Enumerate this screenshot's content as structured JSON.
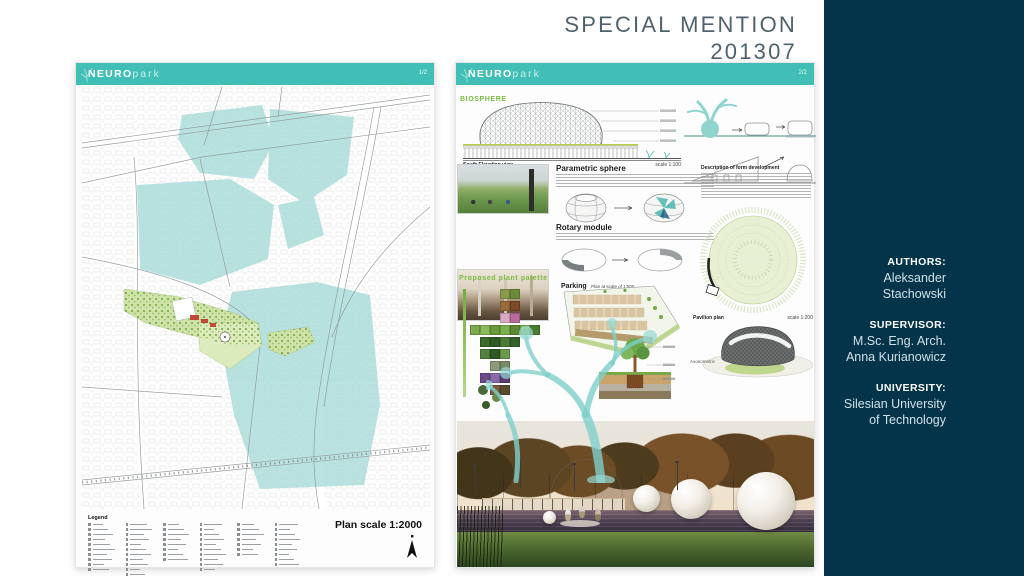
{
  "slide": {
    "title1": "SPECIAL MENTION",
    "title2": "201307"
  },
  "sidebar": {
    "authors_label": "AUTHORS:",
    "authors_name": "Aleksander Stachowski",
    "supervisor_label": "SUPERVISOR:",
    "supervisor_line1": "M.Sc. Eng. Arch.",
    "supervisor_line2": "Anna Kurianowicz",
    "university_label": "UNIVERSITY:",
    "university_line1": "Silesian University",
    "university_line2": "of Technology"
  },
  "posters": {
    "left": {
      "brand_bold": "NEURO",
      "brand_light": "park",
      "page": "1/2",
      "legend_title": "Legend",
      "scale_label": "Plan scale 1:2000"
    },
    "right": {
      "brand_bold": "NEURO",
      "brand_light": "park",
      "page": "2/2",
      "biosphere": "BIOSPHERE",
      "south_elev": "South Elevation view",
      "scale100": "scale 1:100",
      "parametric": "Parametric sphere",
      "rotary": "Rotary module",
      "formdev": "Description of form development",
      "plants": "Proposed plant palette",
      "parking": "Parking",
      "parking_scale": "Plan at scale of 1:500",
      "pavilion": "Pavilion plan",
      "scale200": "scale 1:200",
      "axonometric": "Axonometric",
      "plant_palette_swatches": [
        [
          null,
          null,
          null,
          "#8a9a4a",
          "#6b8a3a",
          null,
          null
        ],
        [
          null,
          null,
          null,
          "#9a6b3a",
          "#7a4a2a",
          null,
          null
        ],
        [
          null,
          null,
          null,
          "#d9a8c4",
          "#b86b9a",
          null,
          null
        ],
        [
          "#7aa84a",
          "#8ab85a",
          "#6b9a3a",
          "#7ab04e",
          "#5a8a34",
          "#86b85a",
          "#4a7a2e"
        ],
        [
          null,
          "#3a6a2a",
          "#2f5a26",
          "#4a7a36",
          "#35622a",
          null,
          null
        ],
        [
          null,
          "#55803d",
          "#2f5a26",
          "#6b9a4a",
          null,
          null,
          null
        ],
        [
          null,
          null,
          "#8a9a7a",
          "#768a68",
          null,
          null,
          null
        ],
        [
          null,
          "#6a4a8a",
          "#8a6aa8",
          "#5a3a78",
          null,
          null,
          null
        ],
        [
          null,
          null,
          "#7a5a3a",
          "#5a4a2e",
          null,
          null,
          null
        ]
      ]
    }
  },
  "colors": {
    "accent_teal": "#41bfb6",
    "sidebar_dark": "#04344a",
    "title_gray": "#50626c",
    "map_highlight_teal": "#a9dcd9",
    "park_green": "#cfe3a8",
    "heading_green": "#77bd43"
  }
}
